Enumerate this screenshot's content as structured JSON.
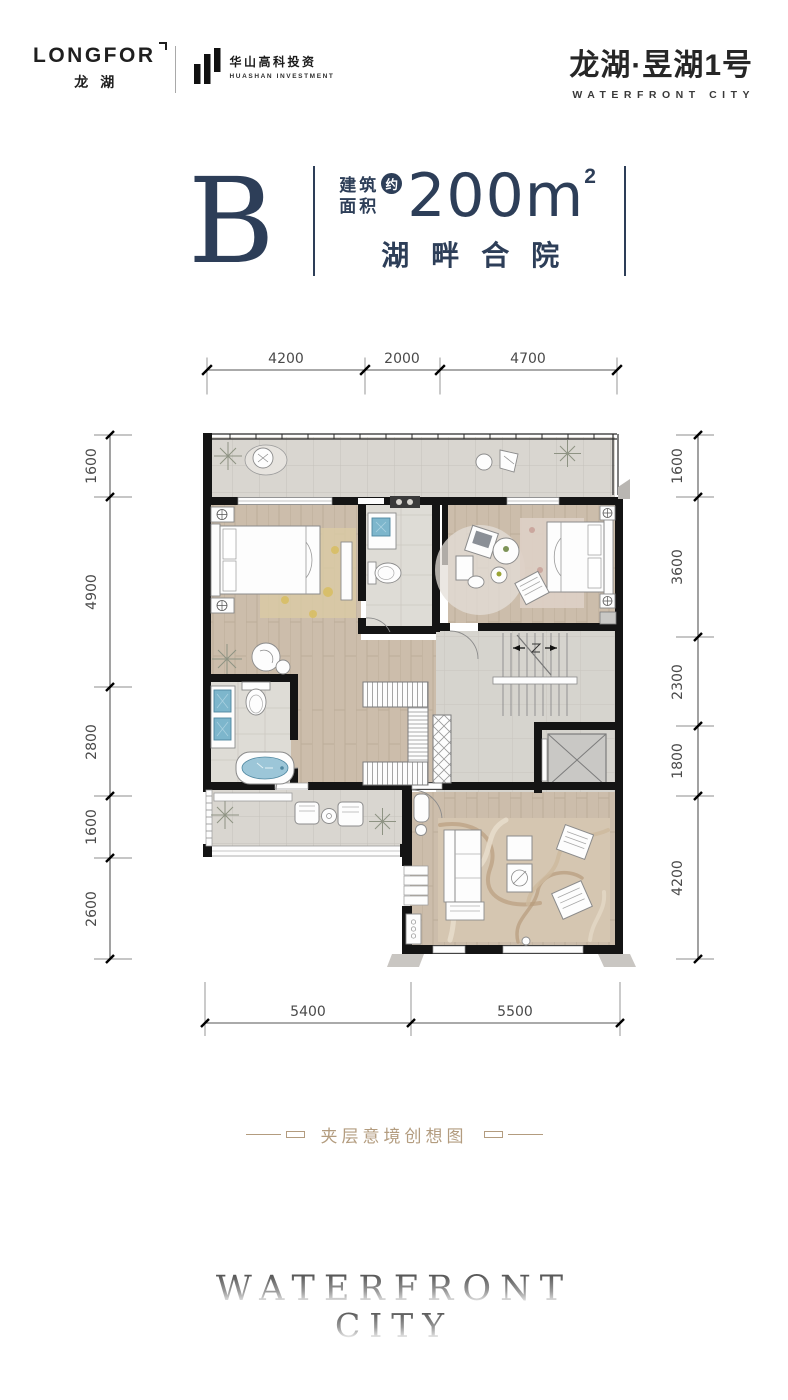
{
  "header": {
    "longfor": {
      "wordmark": "LONGFOR",
      "cn": "龙湖"
    },
    "huashan": {
      "cn": "华山高科投资",
      "en": "HUASHAN INVESTMENT"
    },
    "project": {
      "cn": "龙湖·昱湖1号",
      "en": "WATERFRONT CITY"
    }
  },
  "title_block": {
    "unit": "B",
    "area_label_line1": "建筑",
    "area_label_line2": "面积",
    "approx_badge": "约",
    "area_value": "200m",
    "area_sup": "2",
    "subtitle": "湖畔合院"
  },
  "floor_plan": {
    "dimensions_mm": {
      "top": [
        "4200",
        "2000",
        "4700"
      ],
      "bottom": [
        "5400",
        "5500"
      ],
      "left": [
        "1600",
        "4900",
        "2800",
        "1600",
        "2600"
      ],
      "right": [
        "1600",
        "3600",
        "2300",
        "1800",
        "4200"
      ]
    }
  },
  "caption": {
    "text": "夹层意境创想图"
  },
  "watermark": {
    "line1": "WATERFRONT",
    "line2": "CITY"
  },
  "colors": {
    "navy": "#2d3e58",
    "gold": "#b39c7f",
    "wall": "#141414",
    "wood": "#cbbcaa",
    "tile": "#d9d6d0",
    "blue": "#7db6cc"
  }
}
